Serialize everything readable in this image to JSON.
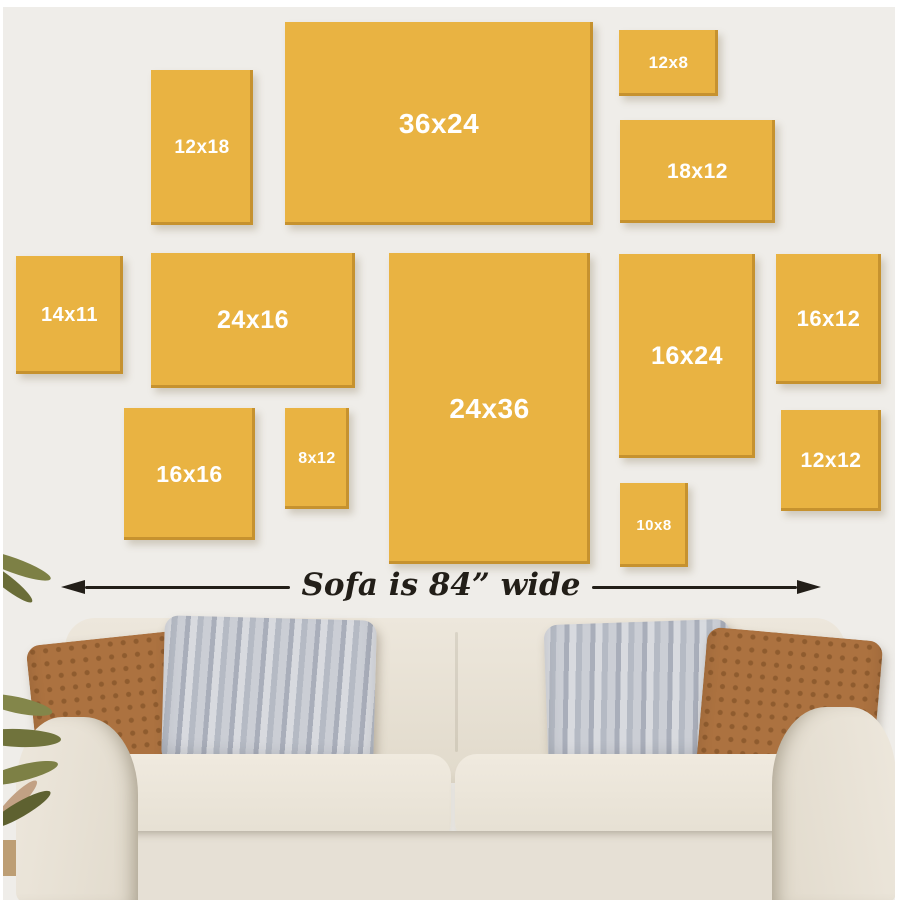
{
  "theme": {
    "wall": "#EFEDE9",
    "frame": "#E9B342",
    "frame-edge": "#C6922F",
    "frame-label": "#FFFFFF",
    "ink": "#221E18",
    "base": "#E6E0D5",
    "pillow-brown": "#AC7240",
    "floor": "#383028"
  },
  "dimension": {
    "caption": "Sofa is 84” wide"
  },
  "frames": [
    {
      "label": "12x18",
      "x": 148,
      "y": 63,
      "w": 102,
      "h": 155,
      "font_px": 19
    },
    {
      "label": "36x24",
      "x": 282,
      "y": 15,
      "w": 308,
      "h": 203,
      "font_px": 28
    },
    {
      "label": "12x8",
      "x": 616,
      "y": 23,
      "w": 99,
      "h": 66,
      "font_px": 17
    },
    {
      "label": "18x12",
      "x": 617,
      "y": 113,
      "w": 155,
      "h": 103,
      "font_px": 21
    },
    {
      "label": "14x11",
      "x": 13,
      "y": 249,
      "w": 107,
      "h": 118,
      "font_px": 20
    },
    {
      "label": "24x16",
      "x": 148,
      "y": 246,
      "w": 204,
      "h": 135,
      "font_px": 25
    },
    {
      "label": "24x36",
      "x": 386,
      "y": 246,
      "w": 201,
      "h": 311,
      "font_px": 28
    },
    {
      "label": "16x24",
      "x": 616,
      "y": 247,
      "w": 136,
      "h": 204,
      "font_px": 25
    },
    {
      "label": "16x12",
      "x": 773,
      "y": 247,
      "w": 105,
      "h": 130,
      "font_px": 22
    },
    {
      "label": "16x16",
      "x": 121,
      "y": 401,
      "w": 131,
      "h": 132,
      "font_px": 23
    },
    {
      "label": "8x12",
      "x": 282,
      "y": 401,
      "w": 64,
      "h": 101,
      "font_px": 16
    },
    {
      "label": "12x12",
      "x": 778,
      "y": 403,
      "w": 100,
      "h": 101,
      "font_px": 21
    },
    {
      "label": "10x8",
      "x": 617,
      "y": 476,
      "w": 68,
      "h": 84,
      "font_px": 15
    }
  ]
}
